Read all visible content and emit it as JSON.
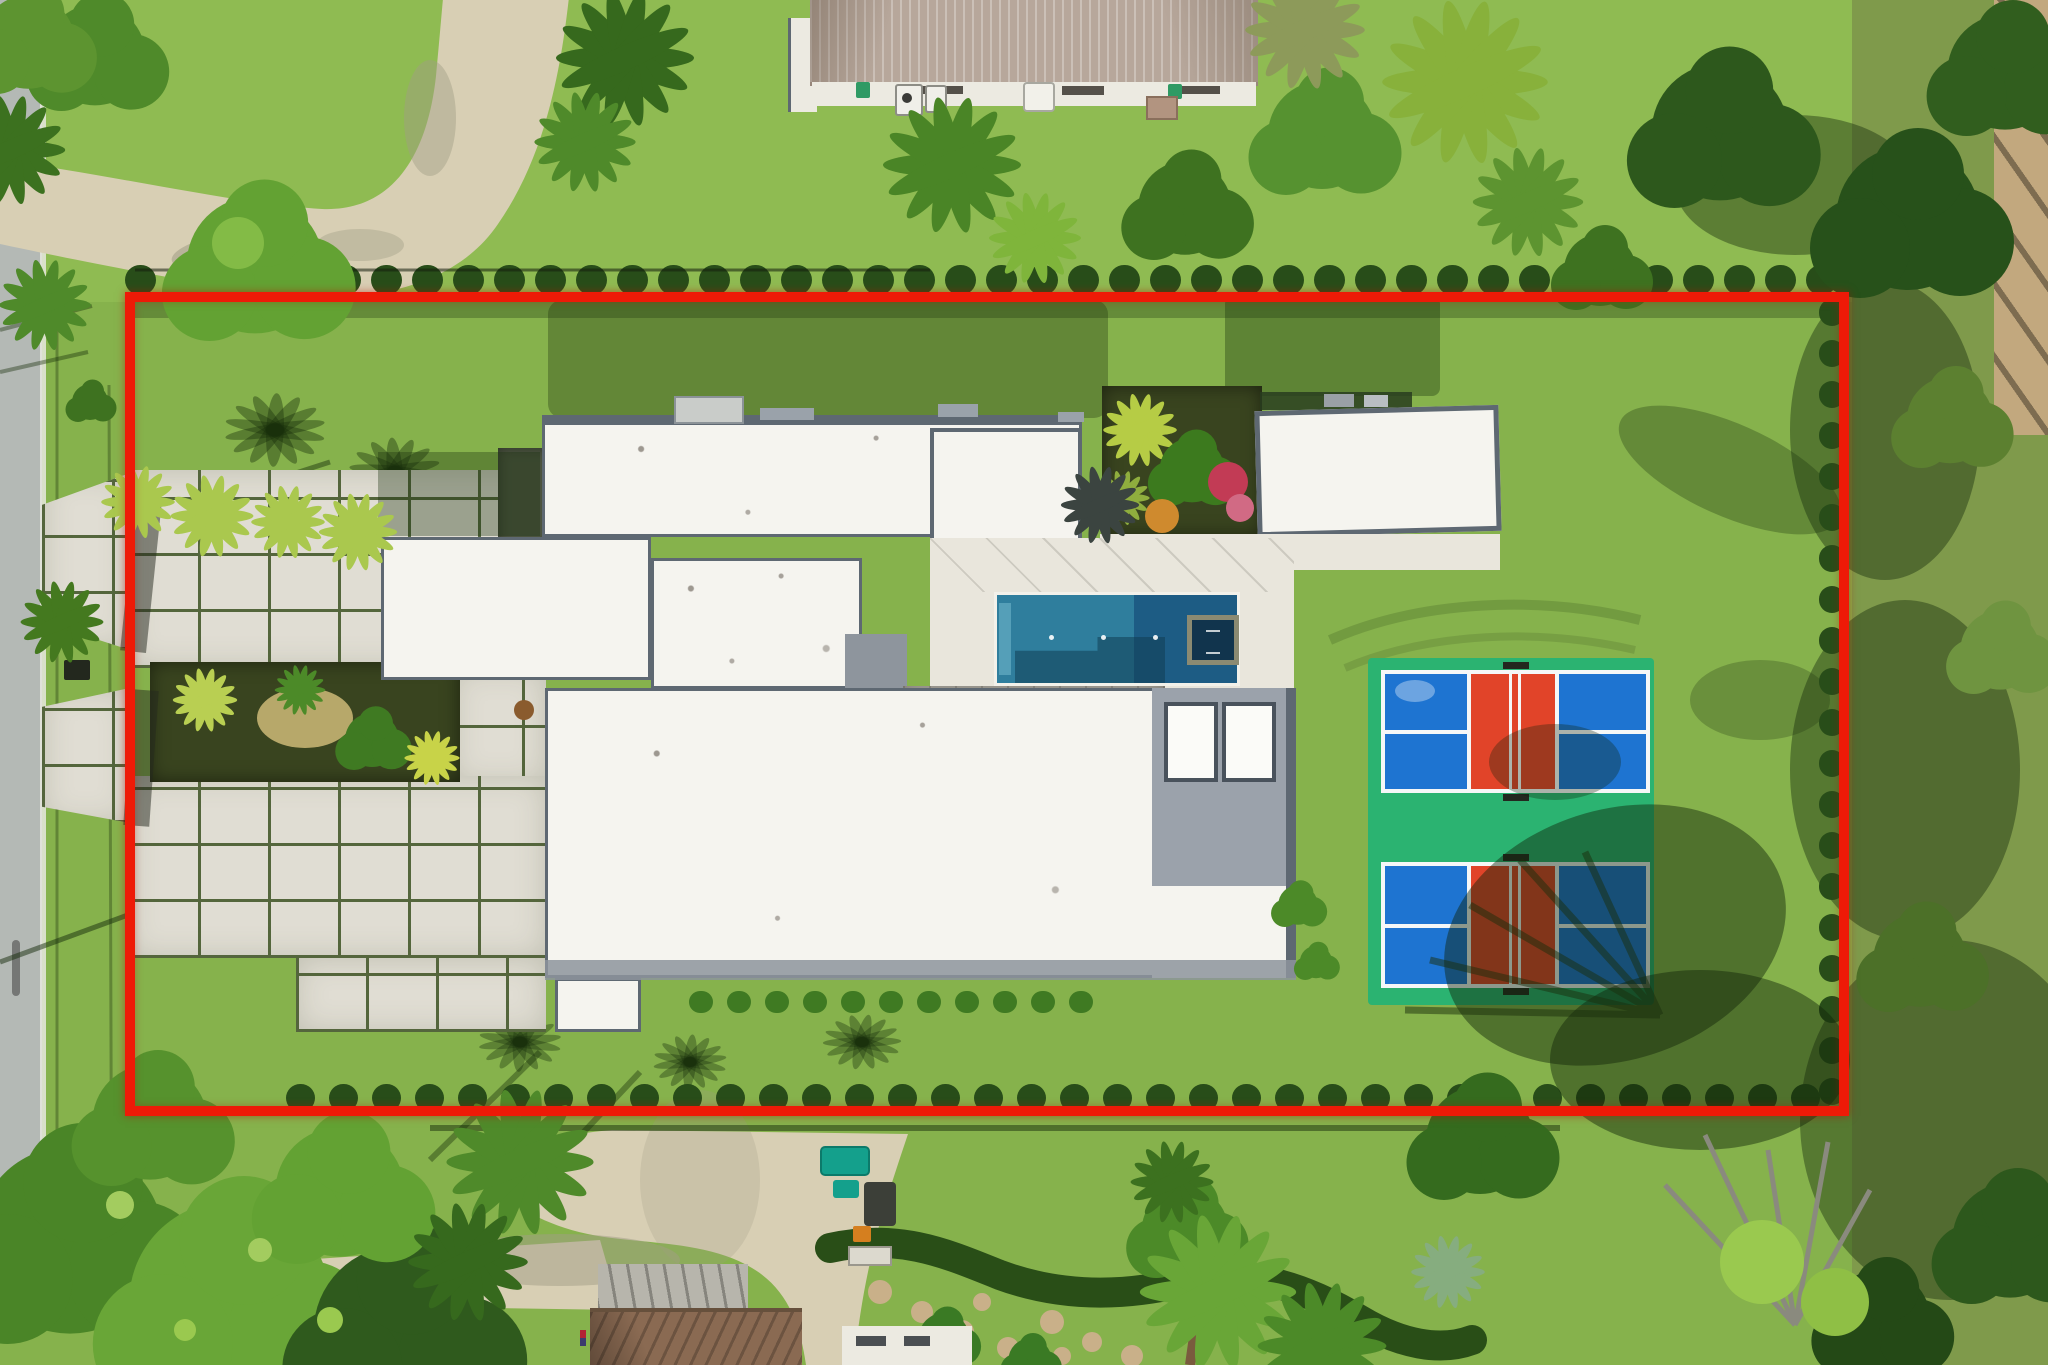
{
  "image": {
    "kind": "aerial-drone-photograph",
    "subject": "residential estate lot with modern white flat-roof house, swimming pool with spa, double pickleball court, paver courtyard and tropical landscaping",
    "overlay": "red property boundary outline",
    "width_px": 2048,
    "height_px": 1365
  },
  "boundary": {
    "color": "#ee1a07",
    "stroke_px": 10,
    "left": 125,
    "top": 292,
    "width": 1724,
    "height": 824
  },
  "palette": {
    "lawn": "#86b24c",
    "lawnTop": "#8fbb52",
    "groundRight": "#7f9a4b",
    "boundaryRed": "#ee1a07",
    "road": "#b4b9b5",
    "roadEdge": "#e8e7df",
    "drive": "#d8cfb4",
    "driveShadow": "#a19d85",
    "paver": "#e0ddd3",
    "paverJoint": "#54663c",
    "mulch": "#39441f",
    "roofWhite": "#f5f4ef",
    "roofTrim": "#5e6872",
    "roofTrimLight": "#9aa2aa",
    "roofSeam": "rgba(115,120,126,0.20)",
    "roofTan": "#b7a79b",
    "roofTanDark": "#97877b",
    "wallWhite": "#eceae1",
    "deckLight": "#e9e6dc",
    "deckDark": "#9b988f",
    "deckLine": "#86837a",
    "poolTeal": "#2f7e9d",
    "poolDeep": "#1d5c84",
    "poolShadow": "rgba(17,62,84,0.55)",
    "poolStep": "#5aa3bb",
    "spaDark": "#11344d",
    "spaFrame": "#8b8a72",
    "courtGreen": "#2bb371",
    "courtBlue": "#1e74d1",
    "courtRed": "#e14429",
    "courtLine": "#f5f7f7",
    "hedge": "#284d19",
    "treeDark": "#2d581c",
    "treeMid": "#4c8a28",
    "treeBright": "#69a637",
    "palmYellow": "#aac84e",
    "shadow": "rgba(22,44,11,0.42)",
    "shadowSoft": "rgba(22,44,11,0.28)",
    "pathTan": "#c2a87e",
    "pathSlash": "#7d6c50",
    "stone": "#c9b089",
    "equipTeal": "#14a08c",
    "equipOrange": "#d57f1f",
    "houseBrown": "#8a6a52",
    "houseBrownDark": "#66503c",
    "flatGray": "#b7b5ac",
    "gateShadow": "rgba(35,40,30,0.5)"
  },
  "scene": {
    "main_house": "white flat roofs with dark gray trim, multiple wings",
    "pool": "rectangular, teal shallow end west, deep blue east, dark square spa at east end",
    "pickleball_court": "green pad, two courts; each court blue service boxes with red kitchen zone and white lines",
    "neighbor_house_top": "tan barrel-tile roof house outside boundary",
    "road": "gray street along left edge",
    "driveways": "curved tan drive at top-left outside boundary; concrete drive and tan stepping-stone garden path at bottom"
  }
}
